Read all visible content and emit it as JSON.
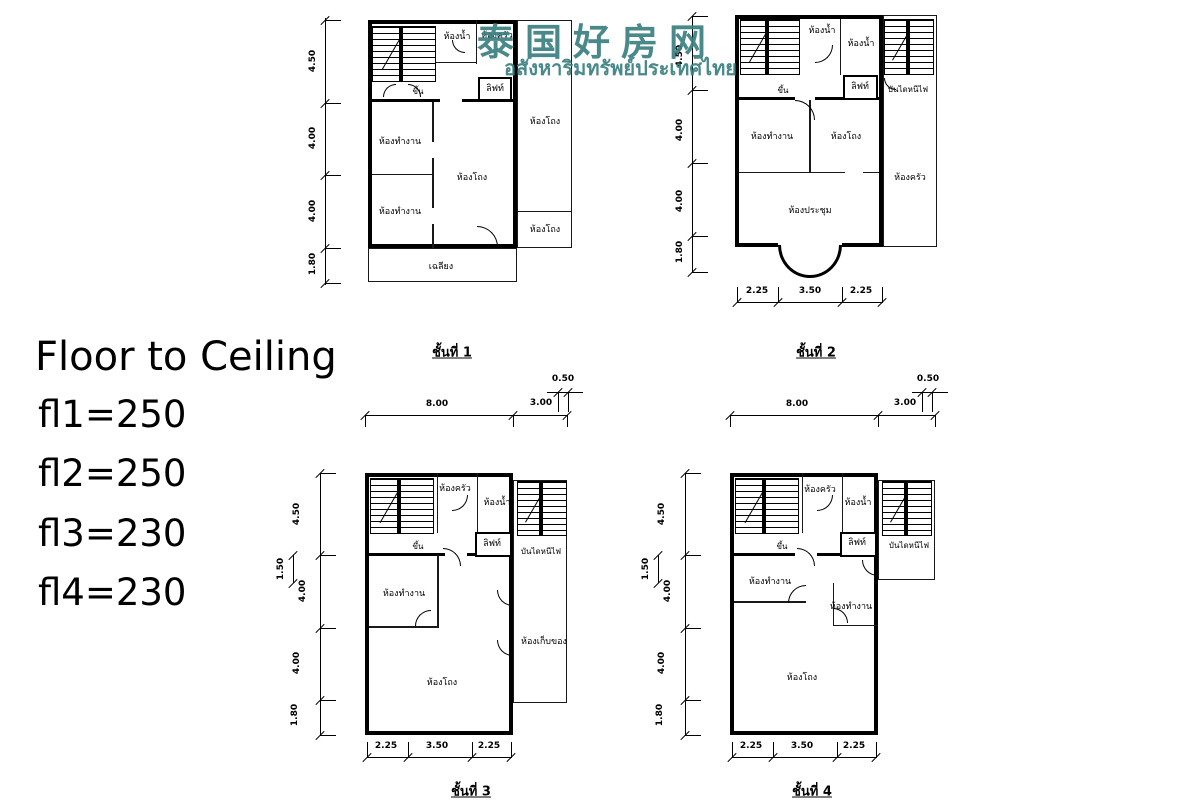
{
  "watermark": {
    "title": "泰国好房网",
    "subtitle": "อสังหาริมทรัพย์ประเทศไทย"
  },
  "colors": {
    "watermark": "#3a7f81",
    "ink": "#000000"
  },
  "note": {
    "title": "Floor to Ceiling",
    "lines": [
      "fl1=250",
      "fl2=250",
      "fl3=230",
      "fl4=230"
    ]
  },
  "plans": [
    {
      "caption": "ชั้นที่ 1",
      "labels": {
        "bath": "ห้องน้ำ",
        "kitchen": "ห้องครัว",
        "lift": "ลิฟท์",
        "up": "ขึ้น",
        "hall_right_top": "ห้องโถง",
        "hall_right_bottom": "ห้องโถง",
        "office1": "ห้องทำงาน",
        "office2": "ห้องทำงาน",
        "hall": "ห้องโถง",
        "porch": "เฉลียง"
      },
      "dims_left": [
        "4.50",
        "4.00",
        "4.00",
        "1.80"
      ]
    },
    {
      "caption": "ชั้นที่ 2",
      "labels": {
        "bath1": "ห้องน้ำ",
        "bath2": "ห้องน้ำ",
        "lift": "ลิฟท์",
        "fire_stairs": "บันไดหนีไฟ",
        "up": "ขึ้น",
        "office": "ห้องทำงาน",
        "hall": "ห้องโถง",
        "kitchen": "ห้องครัว",
        "meeting": "ห้องประชุม"
      },
      "dims_left": [
        "4.50",
        "4.00",
        "4.00",
        "1.80"
      ],
      "dims_bottom": [
        "2.25",
        "3.50",
        "2.25"
      ]
    },
    {
      "caption": "ชั้นที่ 3",
      "labels": {
        "kitchen": "ห้องครัว",
        "bath": "ห้องน้ำ",
        "lift": "ลิฟท์",
        "fire_stairs": "บันไดหนีไฟ",
        "up": "ขึ้น",
        "office": "ห้องทำงาน",
        "storage": "ห้องเก็บของ",
        "hall": "ห้องโถง"
      },
      "dims_left": [
        "4.50",
        "4.00",
        "4.00",
        "1.80"
      ],
      "dims_left_extra": "1.50",
      "dims_top": [
        "8.00",
        "3.00"
      ],
      "dims_top_extra": "0.50",
      "dims_bottom": [
        "2.25",
        "3.50",
        "2.25"
      ]
    },
    {
      "caption": "ชั้นที่ 4",
      "labels": {
        "kitchen": "ห้องครัว",
        "bath": "ห้องน้ำ",
        "lift": "ลิฟท์",
        "fire_stairs": "บันไดหนีไฟ",
        "up": "ขึ้น",
        "office1": "ห้องทำงาน",
        "office2": "ห้องทำงาน",
        "hall": "ห้องโถง"
      },
      "dims_left": [
        "4.50",
        "4.00",
        "4.00",
        "1.80"
      ],
      "dims_left_extra": "1.50",
      "dims_top": [
        "8.00",
        "3.00"
      ],
      "dims_top_extra": "0.50",
      "dims_bottom": [
        "2.25",
        "3.50",
        "2.25"
      ]
    }
  ]
}
